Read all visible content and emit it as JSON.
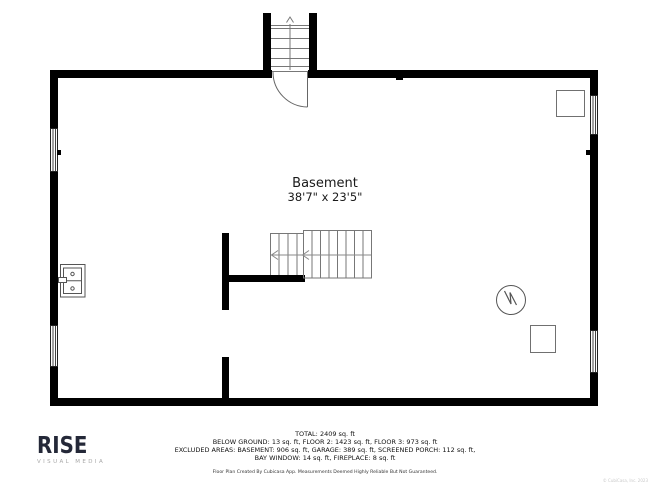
{
  "room": {
    "label": "Basement",
    "dimensions": "38'7\" x 23'5\""
  },
  "summary": {
    "lines": [
      "TOTAL: 2409 sq. ft",
      "BELOW GROUND: 13 sq. ft, FLOOR 2: 1423 sq. ft, FLOOR 3: 973 sq. ft",
      "EXCLUDED AREAS: BASEMENT: 906 sq. ft, GARAGE: 389 sq. ft, SCREENED PORCH: 112 sq. ft,",
      "BAY WINDOW: 14 sq. ft, FIREPLACE: 8 sq. ft"
    ],
    "disclaimer": "Floor Plan Created By Cubicasa App. Measurements Deemed Highly Reliable But Not Guaranteed."
  },
  "branding": {
    "logo": "RISE",
    "tagline": "VISUAL MEDIA",
    "corner_note": "© CubiCasa, Inc. 2023"
  },
  "fixtures": {
    "icons": [
      "stairs-up-icon",
      "door-swing-icon",
      "interior-stairs-icon",
      "window-icon",
      "utility-sink-icon",
      "water-heater-icon",
      "equipment-square-icon"
    ]
  },
  "colors": {
    "wall": "#000000",
    "fixture_line": "#666666",
    "stair_line": "#777777",
    "text": "#1a1a1a",
    "logo_dark": "#242838",
    "logo_gray": "#a8a8a8"
  }
}
